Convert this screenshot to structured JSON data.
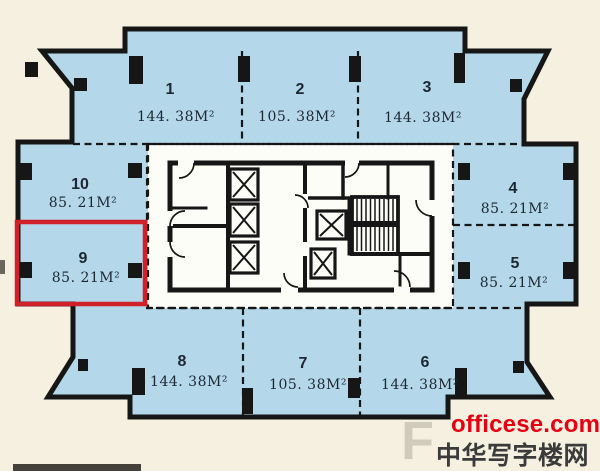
{
  "units": [
    {
      "num": "1",
      "area": "144. 38M²"
    },
    {
      "num": "2",
      "area": "105. 38M²"
    },
    {
      "num": "3",
      "area": "144. 38M²"
    },
    {
      "num": "4",
      "area": "85. 21M²"
    },
    {
      "num": "5",
      "area": "85. 21M²"
    },
    {
      "num": "6",
      "area": "144. 38M²"
    },
    {
      "num": "7",
      "area": "105. 38M²"
    },
    {
      "num": "8",
      "area": "144. 38M²"
    },
    {
      "num": "9",
      "area": "85. 21M²",
      "highlighted": true
    },
    {
      "num": "10",
      "area": "85. 21M²"
    }
  ],
  "watermark": {
    "site": "officese.com",
    "name": "中华写字楼网",
    "ghost": "F"
  },
  "colors": {
    "bg": "#f5f0df",
    "floor": "#b4d8e9",
    "core": "#fdfdf8",
    "wall": "#161616",
    "highlight": "#d0202a",
    "label": "#1d2733",
    "wm-red": "#e60012",
    "wm-dark": "#3b3b3b"
  }
}
